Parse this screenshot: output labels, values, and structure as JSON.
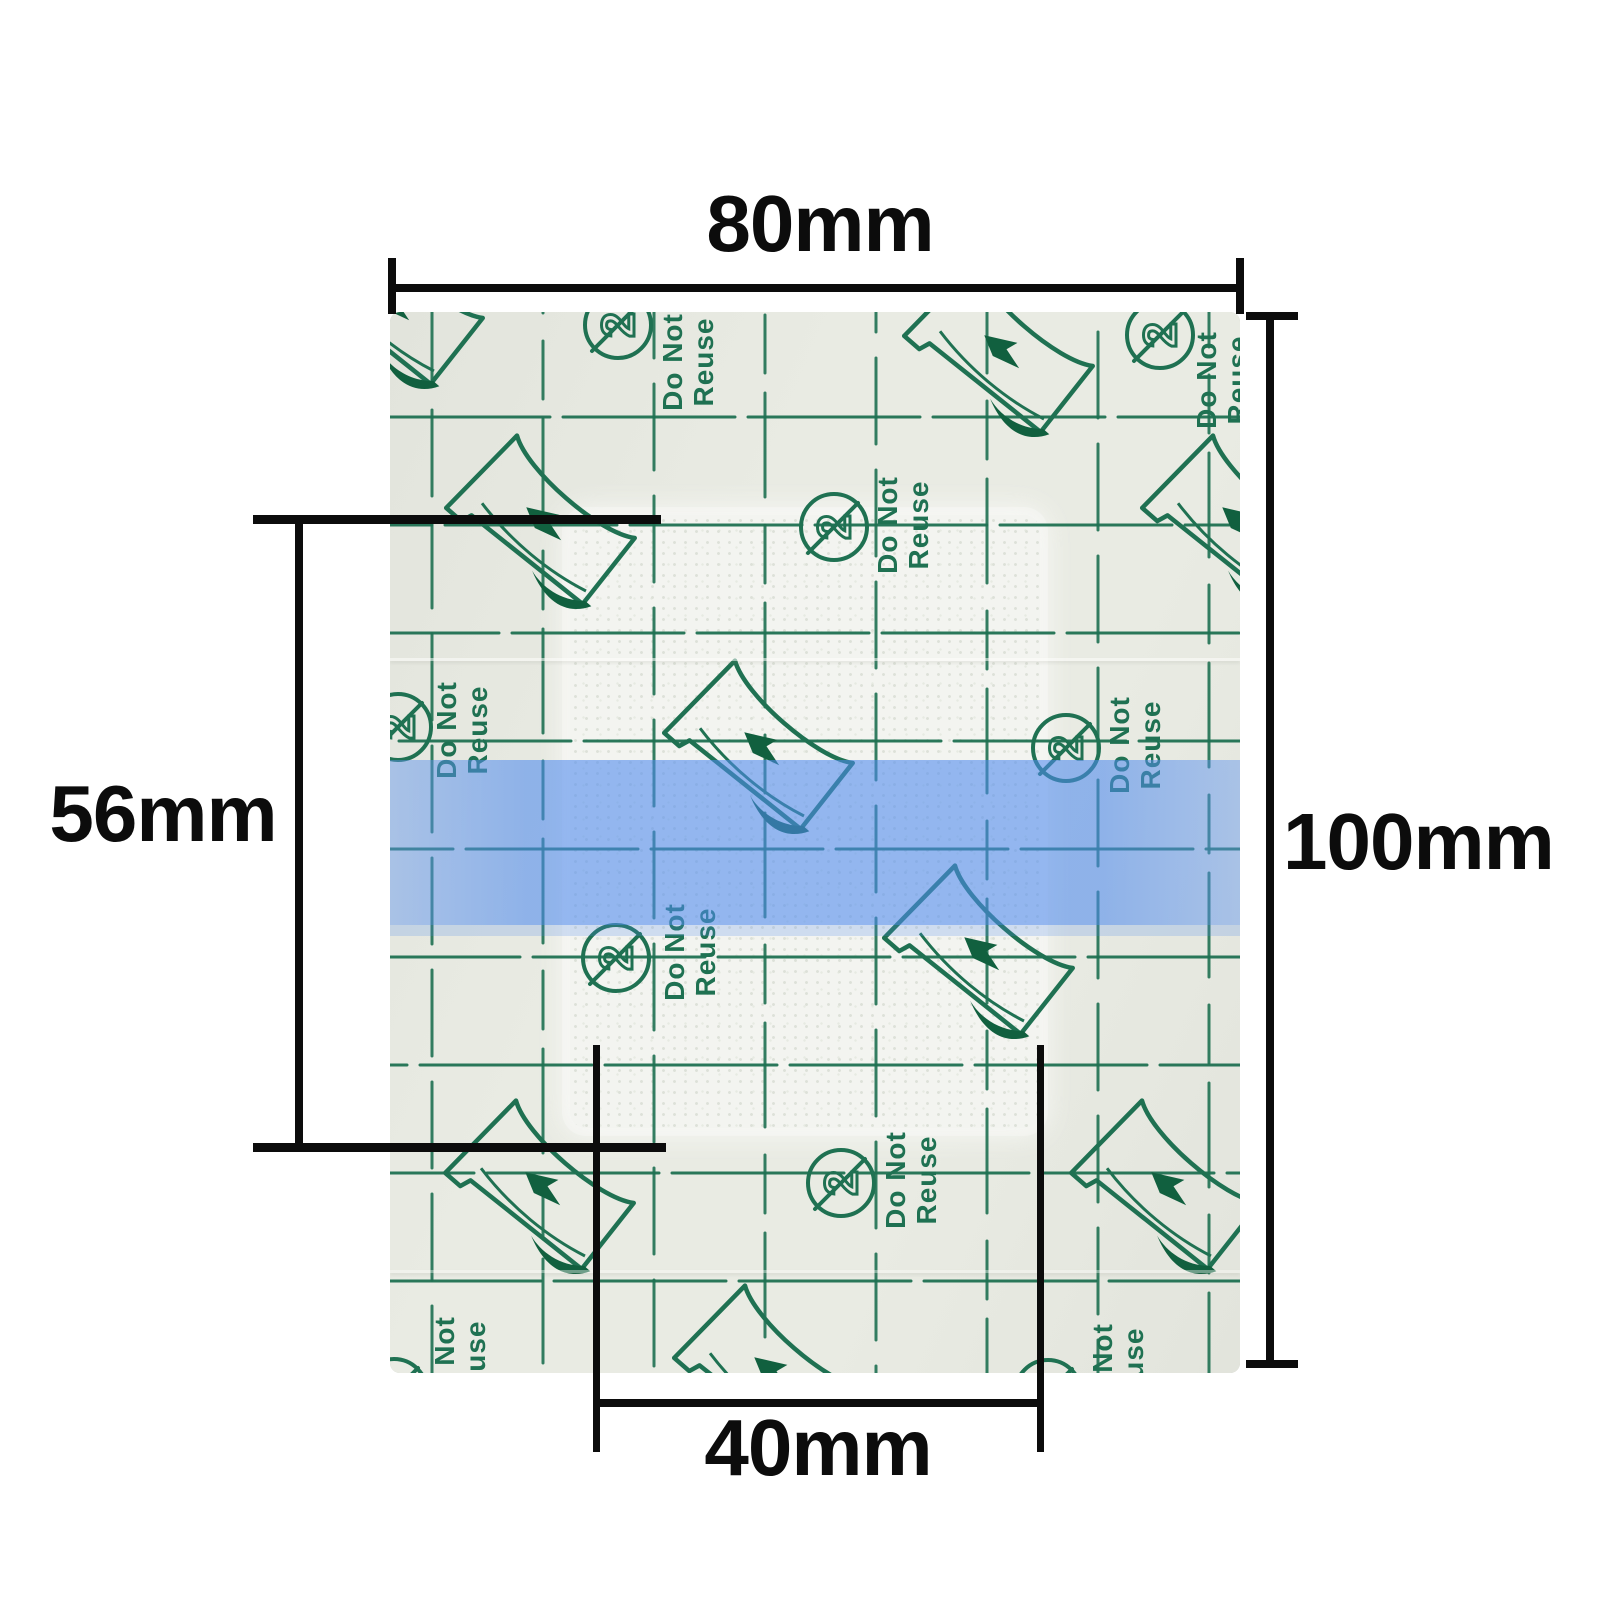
{
  "image_type": "product dimension diagram of a transparent adhesive wound dressing",
  "annotations": {
    "width_label": "80mm",
    "height_label": "100mm",
    "pad_height_label": "56mm",
    "pad_width_label": "40mm",
    "dimension_color": "#0c0c0c"
  },
  "product": {
    "description": "transparent waterproof wound dressing with printed release liner, central absorbent pad and blue removal strip",
    "film_color": "#e9ebe3",
    "film_shade": "#e2e4dc",
    "pad_color": "#f3f4f0",
    "pad_dot_color": "#dde1d8",
    "print_color": "#1f7152",
    "print_dark": "#11603f",
    "blue_strip_color": "rgba(78,138,238,0.58)",
    "blue_strip_soft": "rgba(95,148,238,0.45)",
    "blue_strip_fringe": "rgba(78,138,238,0.22)"
  },
  "print": {
    "do_not_label": "Do Not",
    "reuse_label": "Reuse",
    "reuse_symbol_digit": "2"
  },
  "pattern": {
    "grid_vertical_x": [
      42,
      153,
      264,
      375,
      486,
      597,
      708,
      819
    ],
    "grid_horizontal_y": [
      105,
      213,
      321,
      429,
      537,
      645,
      753,
      861,
      969
    ],
    "h_dash": "172 13",
    "v_dash": [
      "86 26",
      "58 20 104 28"
    ],
    "peel_icons": [
      [
        157,
        208
      ],
      [
        615,
        36
      ],
      [
        375,
        433
      ],
      [
        156,
        873
      ],
      [
        595,
        638
      ],
      [
        385,
        1058
      ],
      [
        853,
        208
      ],
      [
        782,
        873
      ],
      [
        5,
        -12
      ]
    ],
    "dnr_icons": [
      {
        "c": [
          228,
          13
        ],
        "t": [
          298,
          50
        ]
      },
      {
        "c": [
          444,
          215
        ],
        "t": [
          513,
          213
        ]
      },
      {
        "c": [
          8,
          415
        ],
        "t": [
          72,
          418
        ]
      },
      {
        "c": [
          226,
          646
        ],
        "t": [
          300,
          640
        ]
      },
      {
        "c": [
          676,
          436
        ],
        "t": [
          745,
          433
        ]
      },
      {
        "c": [
          451,
          871
        ],
        "t": [
          521,
          868
        ]
      },
      {
        "c": [
          658,
          1081
        ],
        "t": [
          728,
          1060
        ]
      },
      {
        "c": [
          4,
          1080
        ],
        "t": [
          70,
          1053
        ]
      },
      {
        "c": [
          770,
          23
        ],
        "t": [
          832,
          68
        ]
      }
    ]
  }
}
